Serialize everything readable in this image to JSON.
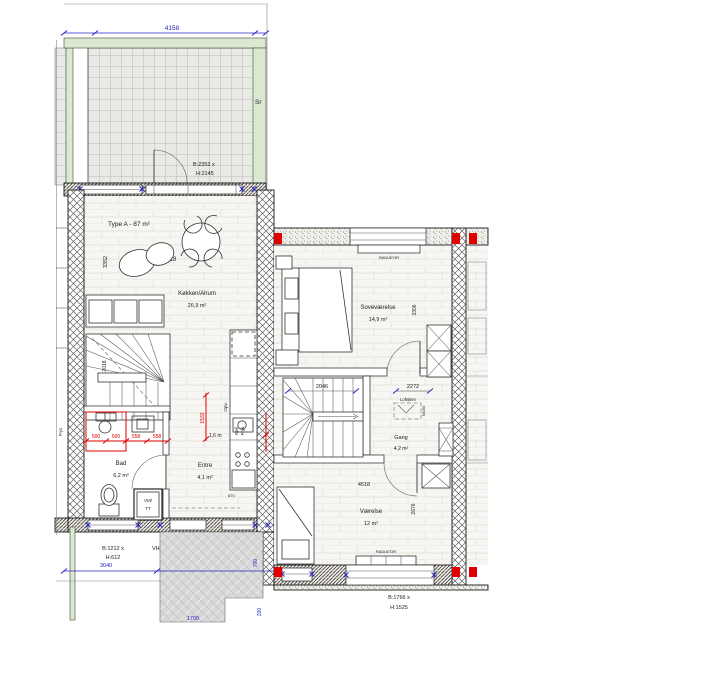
{
  "terrace": {
    "dim_width": "4158",
    "door_b": "B:2352 x",
    "door_h": "H:2145",
    "side_label": "Sr"
  },
  "unit_a": {
    "type_label": "Type A - 87 m²",
    "dim_width": "4518",
    "dim_depth": "3352",
    "stairs_dim": "2018",
    "kitchen": {
      "name": "Køkken/Alrum",
      "area": "26,9 m²",
      "opv": "Opv.",
      "kol": "Køl/",
      "frys": "Frys"
    },
    "bath": {
      "name": "Bad",
      "area": "6,2 m²",
      "d500a": "500",
      "d500b": "500",
      "d558a": "558",
      "d558b": "558",
      "d1533": "1533",
      "width": "1,6 m"
    },
    "entre": {
      "name": "Entre",
      "area": "4,1 m²",
      "dim": "870"
    },
    "wash": {
      "line1": "VM/",
      "line2": "TT"
    },
    "openings": {
      "win1_b": "B:1212 x",
      "win1_h": "H:612",
      "vh": "VH",
      "door_b": "B:1332 x",
      "door_h": "H:2145",
      "ms": "MS"
    },
    "neighbor_label": "Frys"
  },
  "site": {
    "dim_3040": "3040",
    "dim_700": "700",
    "dim_1700": "1700",
    "dim_200": "200"
  },
  "unit_b": {
    "bedroom": {
      "name": "Soveværelse",
      "area": "14,9 m²",
      "dim_depth": "3306",
      "radiator": "RADIATOR"
    },
    "stairs_dim": "2046",
    "hall": {
      "name": "Gang",
      "area": "4,2 m²",
      "dim": "2272",
      "loftslem": "Loftslem",
      "hatch_size": "50x90"
    },
    "room": {
      "name": "Værelse",
      "area": "12 m²",
      "dim_width": "4518",
      "dim_depth": "2676",
      "radiator": "RADIATOR",
      "win_b": "B:1766 x",
      "win_h": "H:1525"
    }
  },
  "colors": {
    "wall_green": "#dbe9d3",
    "dim_blue": "#2424c8",
    "dim_red": "#e00000",
    "walkway_gray": "#d8d8d8"
  }
}
